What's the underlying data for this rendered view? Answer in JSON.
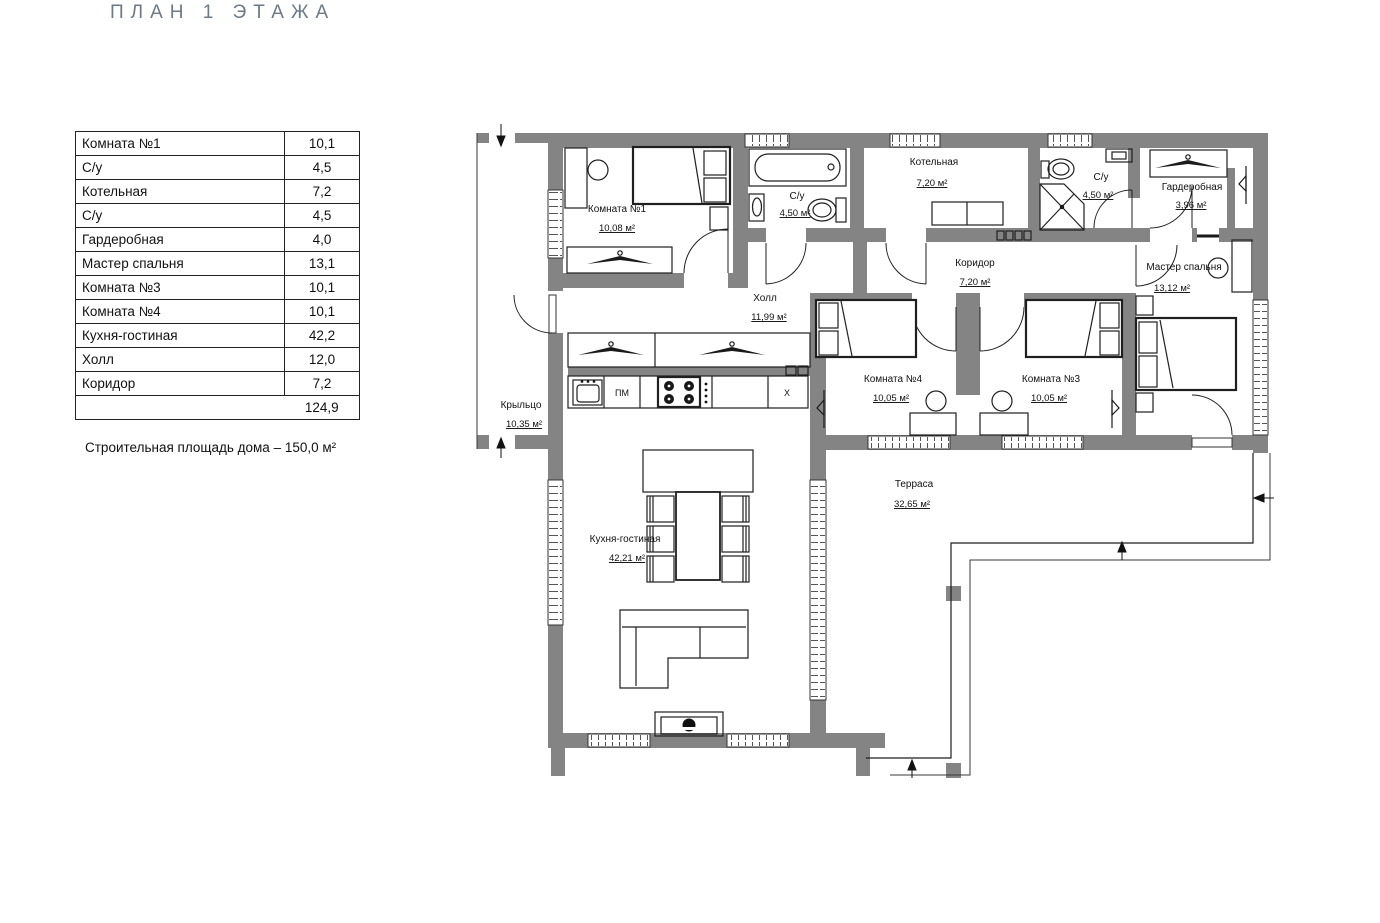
{
  "title": "ПЛАН 1 ЭТАЖА",
  "area_table": {
    "rows": [
      {
        "name": "Комната №1",
        "value": "10,1"
      },
      {
        "name": "С/у",
        "value": "4,5"
      },
      {
        "name": "Котельная",
        "value": "7,2"
      },
      {
        "name": "С/у",
        "value": "4,5"
      },
      {
        "name": "Гардеробная",
        "value": "4,0"
      },
      {
        "name": "Мастер спальня",
        "value": "13,1"
      },
      {
        "name": "Комната №3",
        "value": "10,1"
      },
      {
        "name": "Комната №4",
        "value": "10,1"
      },
      {
        "name": "Кухня-гостиная",
        "value": "42,2"
      },
      {
        "name": "Холл",
        "value": "12,0"
      },
      {
        "name": "Коридор",
        "value": "7,2"
      }
    ],
    "total": "124,9"
  },
  "note": "Строительная площадь дома – 150,0 м²",
  "plan": {
    "rooms": [
      {
        "name": "Комната №1",
        "area": "10,08 м²"
      },
      {
        "name": "С/у",
        "area": "4,50 м²"
      },
      {
        "name": "Котельная",
        "area": "7,20 м²"
      },
      {
        "name": "Холл",
        "area": "11,99 м²"
      },
      {
        "name": "С/у",
        "area": "4,50 м²"
      },
      {
        "name": "Гардеробная",
        "area": "3,96 м²"
      },
      {
        "name": "Коридор",
        "area": "7,20 м²"
      },
      {
        "name": "Мастер спальня",
        "area": "13,12 м²"
      },
      {
        "name": "Комната №4",
        "area": "10,05 м²"
      },
      {
        "name": "Комната №3",
        "area": "10,05 м²"
      },
      {
        "name": "Кухня-гостиная",
        "area": "42,21 м²"
      },
      {
        "name": "Крыльцо",
        "area": "10,35 м²"
      },
      {
        "name": "Терраса",
        "area": "32,65 м²"
      }
    ],
    "appliances": {
      "dishwasher": "ПМ",
      "fridge": "Х"
    },
    "colors": {
      "wall": "#848484",
      "line": "#1f1f1f",
      "title": "#6e7987"
    }
  }
}
